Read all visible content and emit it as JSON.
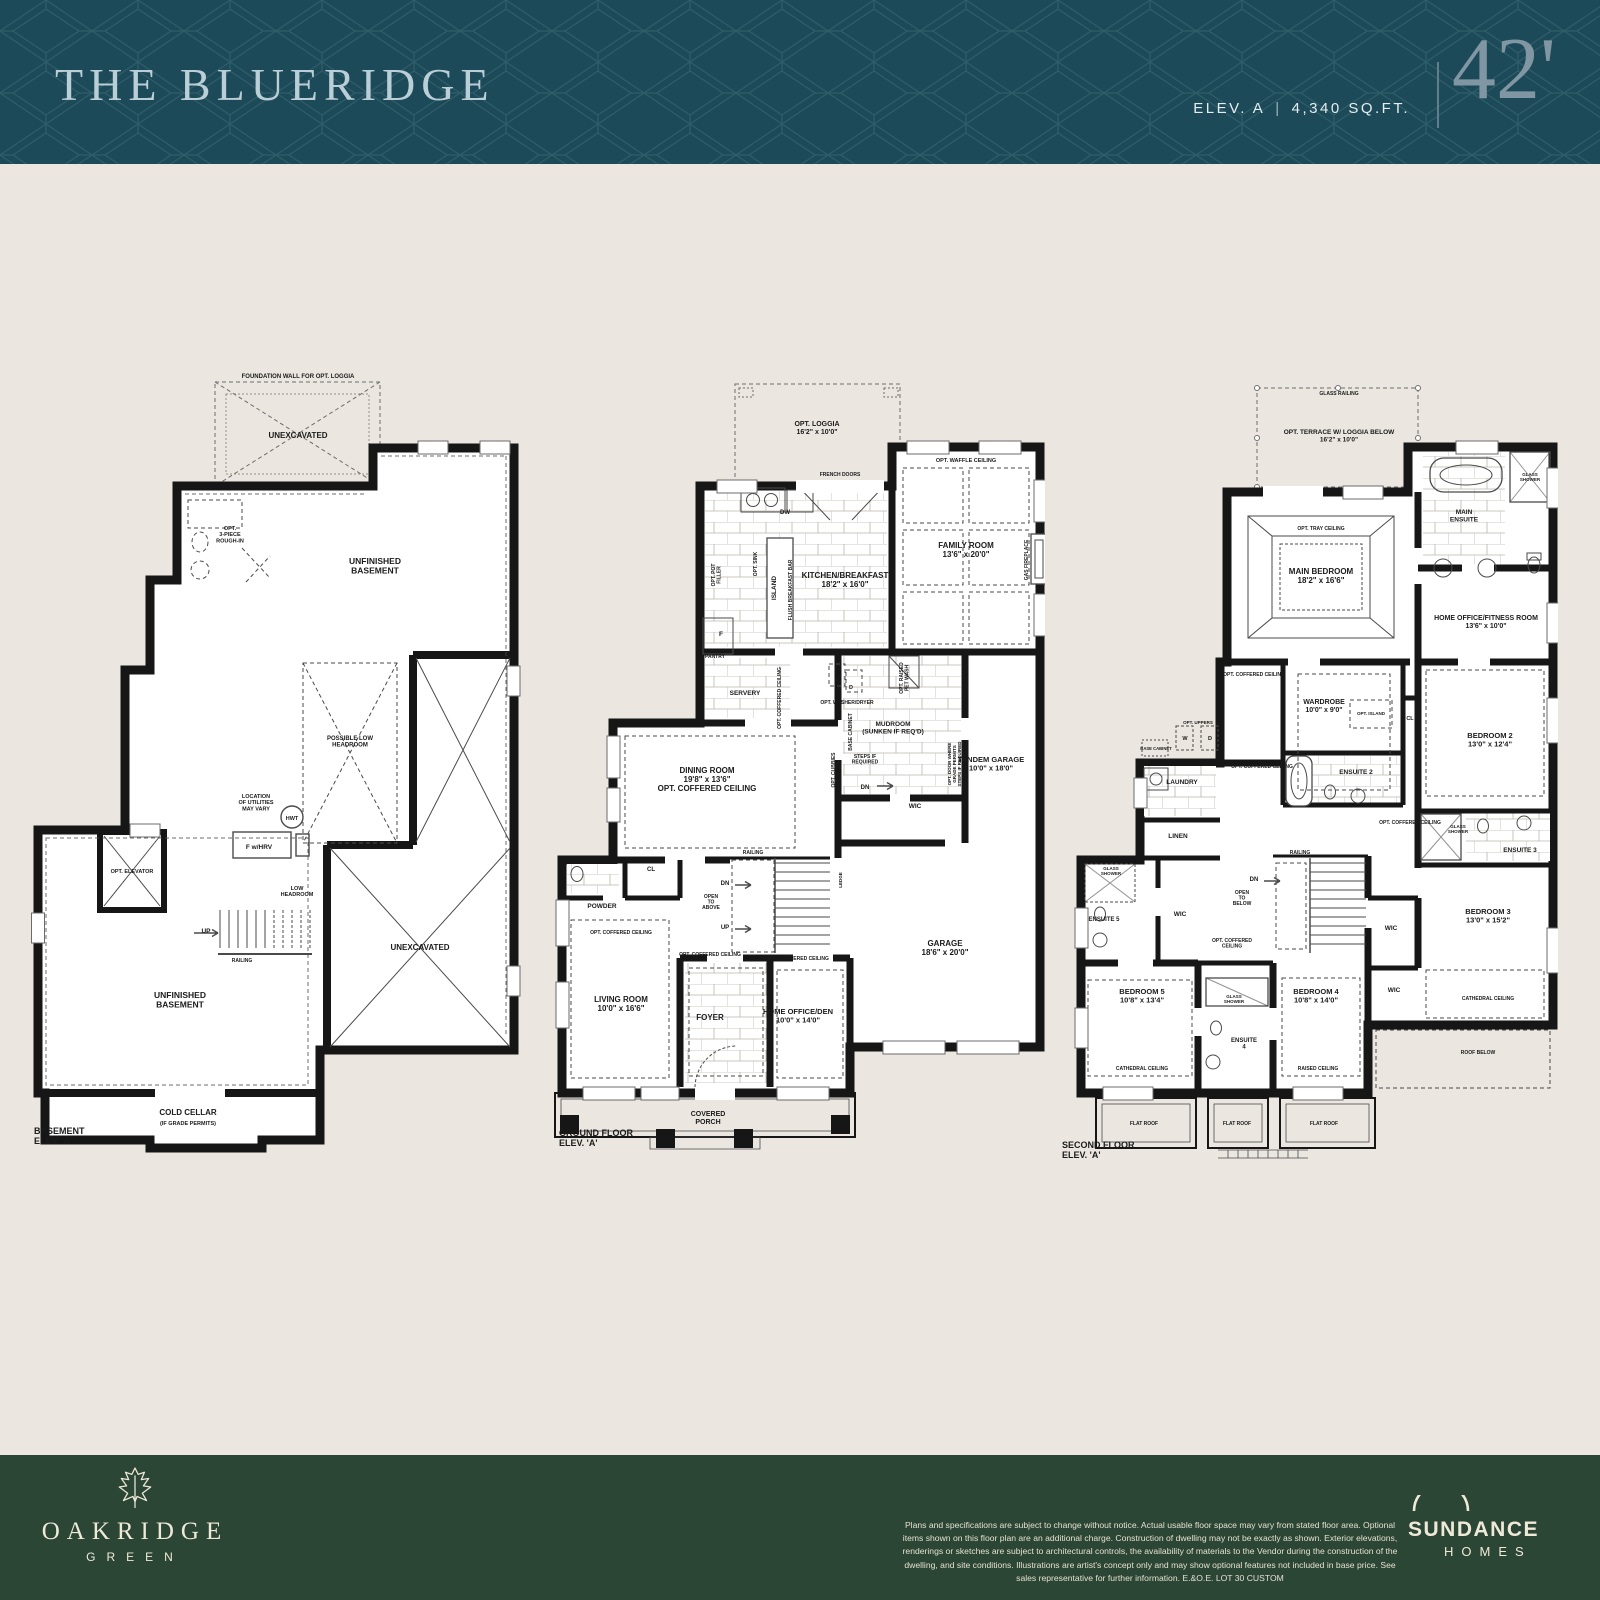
{
  "header": {
    "title": "THE BLUERIDGE",
    "elevation": "ELEV. A",
    "separator": "|",
    "area": "4,340 SQ.FT.",
    "lot_width": "42'"
  },
  "colors": {
    "header_bg": "#1c4a59",
    "header_title": "#b9ced6",
    "header_accent": "#8096a3",
    "page_bg": "#ebe6e0",
    "wall": "#161616",
    "footer_bg": "#2b4634",
    "footer_text": "#efe9da"
  },
  "plans": [
    {
      "id": "basement",
      "caption": "BASEMENT ELEV. 'A'",
      "labels": [
        {
          "t": "FOUNDATION WALL FOR OPT. LOGGIA",
          "x": 268,
          "y": 10,
          "s": 6
        },
        {
          "t": "UNEXCAVATED",
          "x": 268,
          "y": 70,
          "s": 8
        },
        {
          "t": "OPT.\n3-PIECE\nROUGH-IN",
          "x": 200,
          "y": 162,
          "s": 5.5
        },
        {
          "t": "UNFINISHED\nBASEMENT",
          "x": 345,
          "y": 196,
          "s": 8.5
        },
        {
          "t": "POSSIBLE LOW\nHEADROOM",
          "x": 320,
          "y": 372,
          "s": 6
        },
        {
          "t": "LOCATION\nOF UTILITIES\nMAY VARY",
          "x": 226,
          "y": 430,
          "s": 5.5
        },
        {
          "t": "HWT",
          "x": 262,
          "y": 452,
          "s": 5.5
        },
        {
          "t": "F w/HRV",
          "x": 229,
          "y": 481,
          "s": 6.5
        },
        {
          "t": "OPT. ELEVATOR",
          "x": 102,
          "y": 505,
          "s": 5.5
        },
        {
          "t": "LOW\nHEADROOM",
          "x": 267,
          "y": 522,
          "s": 5.5
        },
        {
          "t": "UP",
          "x": 176,
          "y": 565,
          "s": 6.5
        },
        {
          "t": "RAILING",
          "x": 212,
          "y": 594,
          "s": 5
        },
        {
          "t": "UNFINISHED\nBASEMENT",
          "x": 150,
          "y": 630,
          "s": 8.5
        },
        {
          "t": "UNEXCAVATED",
          "x": 390,
          "y": 582,
          "s": 8
        },
        {
          "t": "COLD CELLAR",
          "x": 158,
          "y": 747,
          "s": 8
        },
        {
          "t": "(IF GRADE PERMITS)",
          "x": 158,
          "y": 757,
          "s": 5.5
        },
        {
          "t": "BASEMENT\nELEV. 'A'",
          "x": 4,
          "y": 766,
          "s": 9,
          "a": "start"
        }
      ]
    },
    {
      "id": "ground",
      "caption": "GROUND FLOOR ELEV. 'A'",
      "labels": [
        {
          "t": "OPT. LOGGIA\n16'2\" x 10'0\"",
          "x": 272,
          "y": 58,
          "s": 7
        },
        {
          "t": "FRENCH DOORS",
          "x": 295,
          "y": 108,
          "s": 5
        },
        {
          "t": "DW",
          "x": 240,
          "y": 146,
          "s": 6
        },
        {
          "t": "OPT. WAFFLE CEILING",
          "x": 421,
          "y": 94,
          "s": 5.5
        },
        {
          "t": "FAMILY ROOM\n13'6\" x 20'0\"",
          "x": 421,
          "y": 180,
          "s": 8
        },
        {
          "t": "GAS FIREPLACE",
          "x": 483,
          "y": 192,
          "s": 5,
          "r": -90
        },
        {
          "t": "OPT. SINK",
          "x": 212,
          "y": 196,
          "s": 5,
          "r": -90
        },
        {
          "t": "ISLAND",
          "x": 231,
          "y": 220,
          "s": 6.5,
          "r": -90
        },
        {
          "t": "FLUSH BREAKFAST BAR",
          "x": 247,
          "y": 222,
          "s": 5,
          "r": -90
        },
        {
          "t": "KITCHEN/BREAKFAST\n18'2\" x 16'0\"",
          "x": 300,
          "y": 210,
          "s": 8
        },
        {
          "t": "OPT. POT\nFILLER",
          "x": 170,
          "y": 207,
          "s": 5,
          "r": -90
        },
        {
          "t": "F",
          "x": 176,
          "y": 268,
          "s": 6.5
        },
        {
          "t": "PANTRY",
          "x": 170,
          "y": 290,
          "s": 5
        },
        {
          "t": "SERVERY",
          "x": 200,
          "y": 327,
          "s": 6.5
        },
        {
          "t": "OPT. COFFERED CEILING",
          "x": 236,
          "y": 330,
          "s": 5,
          "r": -90
        },
        {
          "t": "W",
          "x": 292,
          "y": 313,
          "s": 5.5
        },
        {
          "t": "D",
          "x": 306,
          "y": 321,
          "s": 5.5
        },
        {
          "t": "OPT. WASHER/DRYER",
          "x": 302,
          "y": 336,
          "s": 5
        },
        {
          "t": "OPT. RAISED\nPET WASH",
          "x": 358,
          "y": 310,
          "s": 5,
          "r": -90
        },
        {
          "t": "BASE CABINET",
          "x": 307,
          "y": 364,
          "s": 5,
          "r": -90
        },
        {
          "t": "MUDROOM\n(SUNKEN IF REQ'D)",
          "x": 348,
          "y": 358,
          "s": 6.5
        },
        {
          "t": "OPT. CUBBIES",
          "x": 290,
          "y": 402,
          "s": 5,
          "r": -90
        },
        {
          "t": "STEPS IF\nREQUIRED",
          "x": 320,
          "y": 390,
          "s": 5
        },
        {
          "t": "DN",
          "x": 320,
          "y": 421,
          "s": 6
        },
        {
          "t": "WIC",
          "x": 370,
          "y": 440,
          "s": 6.5
        },
        {
          "t": "OPT. DOOR WHERE\nGRADE PERMITS\nSTEPS IF REQUIRED",
          "x": 406,
          "y": 396,
          "s": 4.5,
          "r": -90
        },
        {
          "t": "TANDEM GARAGE\n10'0\" x 18'0\"",
          "x": 446,
          "y": 394,
          "s": 7.5
        },
        {
          "t": "DINING ROOM\n19'8\" x 13'6\"\nOPT. COFFERED CEILING",
          "x": 162,
          "y": 405,
          "s": 8
        },
        {
          "t": "RAILING",
          "x": 208,
          "y": 486,
          "s": 5
        },
        {
          "t": "CL",
          "x": 106,
          "y": 503,
          "s": 6
        },
        {
          "t": "DN",
          "x": 180,
          "y": 517,
          "s": 6
        },
        {
          "t": "OPEN\nTO\nABOVE",
          "x": 166,
          "y": 530,
          "s": 5
        },
        {
          "t": "UP",
          "x": 180,
          "y": 561,
          "s": 6
        },
        {
          "t": "POWDER",
          "x": 57,
          "y": 540,
          "s": 6.5
        },
        {
          "t": "LEDGE",
          "x": 297,
          "y": 512,
          "s": 4.5,
          "r": -90
        },
        {
          "t": "OPT. COFFERED CEILING",
          "x": 76,
          "y": 566,
          "s": 5
        },
        {
          "t": "LIVING ROOM\n10'0\" x 16'6\"",
          "x": 76,
          "y": 634,
          "s": 8
        },
        {
          "t": "OPT. COFFERED CEILING",
          "x": 165,
          "y": 588,
          "s": 5
        },
        {
          "t": "FOYER",
          "x": 165,
          "y": 652,
          "s": 8
        },
        {
          "t": "OPT. COFFERED CEILING",
          "x": 253,
          "y": 592,
          "s": 5
        },
        {
          "t": "HOME OFFICE/DEN\n10'0\" x 14'0\"",
          "x": 253,
          "y": 646,
          "s": 7.5
        },
        {
          "t": "GARAGE\n18'6\" x 20'0\"",
          "x": 400,
          "y": 578,
          "s": 8
        },
        {
          "t": "COVERED\nPORCH",
          "x": 163,
          "y": 748,
          "s": 7
        },
        {
          "t": "GROUND FLOOR\nELEV. 'A'",
          "x": 14,
          "y": 768,
          "s": 9,
          "a": "start"
        }
      ]
    },
    {
      "id": "second",
      "caption": "SECOND FLOOR ELEV. 'A'",
      "labels": [
        {
          "t": "GLASS RAILING",
          "x": 281,
          "y": 27,
          "s": 5
        },
        {
          "t": "OPT. TERRACE W/ LOGGIA BELOW\n16'2\" x 10'0\"",
          "x": 281,
          "y": 66,
          "s": 6.5
        },
        {
          "t": "OPT. TRAY CEILING",
          "x": 263,
          "y": 162,
          "s": 5
        },
        {
          "t": "MAIN BEDROOM\n18'2\" x 16'6\"",
          "x": 263,
          "y": 206,
          "s": 8
        },
        {
          "t": "MAIN\nENSUITE",
          "x": 406,
          "y": 146,
          "s": 6.5
        },
        {
          "t": "GLASS\nSHOWER",
          "x": 472,
          "y": 108,
          "s": 4.5
        },
        {
          "t": "HOME OFFICE/FITNESS ROOM\n13'6\" x 10'0\"",
          "x": 428,
          "y": 252,
          "s": 7
        },
        {
          "t": "OPT. COFFERED CEILING",
          "x": 196,
          "y": 308,
          "s": 5
        },
        {
          "t": "WARDROBE\n10'0\" x 9'0\"",
          "x": 266,
          "y": 336,
          "s": 7
        },
        {
          "t": "OPT. ISLAND",
          "x": 313,
          "y": 347,
          "s": 4.5
        },
        {
          "t": "CL",
          "x": 352,
          "y": 352,
          "s": 5.5
        },
        {
          "t": "BEDROOM 2\n13'0\" x 12'4\"",
          "x": 432,
          "y": 370,
          "s": 7.5
        },
        {
          "t": "OPT. UPPERS",
          "x": 140,
          "y": 356,
          "s": 4.5
        },
        {
          "t": "W",
          "x": 127,
          "y": 372,
          "s": 5.5
        },
        {
          "t": "D",
          "x": 152,
          "y": 372,
          "s": 5.5
        },
        {
          "t": "BASE CABINET",
          "x": 98,
          "y": 382,
          "s": 4.2
        },
        {
          "t": "LAUNDRY",
          "x": 124,
          "y": 416,
          "s": 6.5
        },
        {
          "t": "OPT. COFFERED CEILING",
          "x": 204,
          "y": 400,
          "s": 5
        },
        {
          "t": "ENSUITE 2",
          "x": 298,
          "y": 406,
          "s": 6.5
        },
        {
          "t": "LINEN",
          "x": 120,
          "y": 470,
          "s": 6.5
        },
        {
          "t": "OPT. COFFERED CEILING",
          "x": 352,
          "y": 456,
          "s": 5
        },
        {
          "t": "GLASS\nSHOWER",
          "x": 400,
          "y": 460,
          "s": 4.5
        },
        {
          "t": "ENSUITE 3",
          "x": 462,
          "y": 484,
          "s": 6.5
        },
        {
          "t": "RAILING",
          "x": 242,
          "y": 486,
          "s": 5
        },
        {
          "t": "DN",
          "x": 196,
          "y": 513,
          "s": 6
        },
        {
          "t": "OPEN\nTO\nBELOW",
          "x": 184,
          "y": 526,
          "s": 5
        },
        {
          "t": "OPT. COFFERED\nCEILING",
          "x": 174,
          "y": 574,
          "s": 5
        },
        {
          "t": "GLASS\nSHOWER",
          "x": 53,
          "y": 502,
          "s": 4.5
        },
        {
          "t": "ENSUITE 5",
          "x": 46,
          "y": 553,
          "s": 6
        },
        {
          "t": "WIC",
          "x": 122,
          "y": 548,
          "s": 6.5
        },
        {
          "t": "WIC",
          "x": 333,
          "y": 562,
          "s": 6.5
        },
        {
          "t": "BEDROOM 3\n13'0\" x 15'2\"",
          "x": 430,
          "y": 546,
          "s": 7.5
        },
        {
          "t": "WIC",
          "x": 336,
          "y": 624,
          "s": 6.5
        },
        {
          "t": "BEDROOM 5\n10'8\" x 13'4\"",
          "x": 84,
          "y": 626,
          "s": 7.5
        },
        {
          "t": "CATHEDRAL CEILING",
          "x": 84,
          "y": 702,
          "s": 5
        },
        {
          "t": "GLASS\nSHOWER",
          "x": 176,
          "y": 630,
          "s": 4.5
        },
        {
          "t": "ENSUITE\n4",
          "x": 186,
          "y": 674,
          "s": 6
        },
        {
          "t": "BEDROOM 4\n10'8\" x 14'0\"",
          "x": 258,
          "y": 626,
          "s": 7.5
        },
        {
          "t": "RAISED CEILING",
          "x": 260,
          "y": 702,
          "s": 5
        },
        {
          "t": "CATHEDRAL CEILING",
          "x": 430,
          "y": 632,
          "s": 5
        },
        {
          "t": "ROOF BELOW",
          "x": 420,
          "y": 686,
          "s": 5
        },
        {
          "t": "FLAT ROOF",
          "x": 86,
          "y": 757,
          "s": 5
        },
        {
          "t": "FLAT ROOF",
          "x": 179,
          "y": 757,
          "s": 5
        },
        {
          "t": "FLAT ROOF",
          "x": 266,
          "y": 757,
          "s": 5
        },
        {
          "t": "SECOND FLOOR\nELEV. 'A'",
          "x": 4,
          "y": 780,
          "s": 9,
          "a": "start"
        }
      ]
    }
  ],
  "footer": {
    "community_logo": {
      "icon": "oak-leaf-icon",
      "name": "OAKRIDGE",
      "sub": "GREEN"
    },
    "builder_logo": {
      "icon": "sun-arc-icon",
      "name": "SUNDANCE",
      "sub": "HOMES"
    },
    "disclaimer": "Plans and specifications are subject to change without notice. Actual usable floor space may vary from stated floor area. Optional items shown on this floor plan are an additional charge. Construction of dwelling may not be exactly as shown. Exterior elevations, renderings or sketches are subject to architectural controls, the availability of materials to the Vendor during the construction of the dwelling, and site conditions. Illustrations are artist's concept only and may show optional features not included in base price. See sales representative for further information. E.&O.E.  LOT 30 CUSTOM"
  }
}
